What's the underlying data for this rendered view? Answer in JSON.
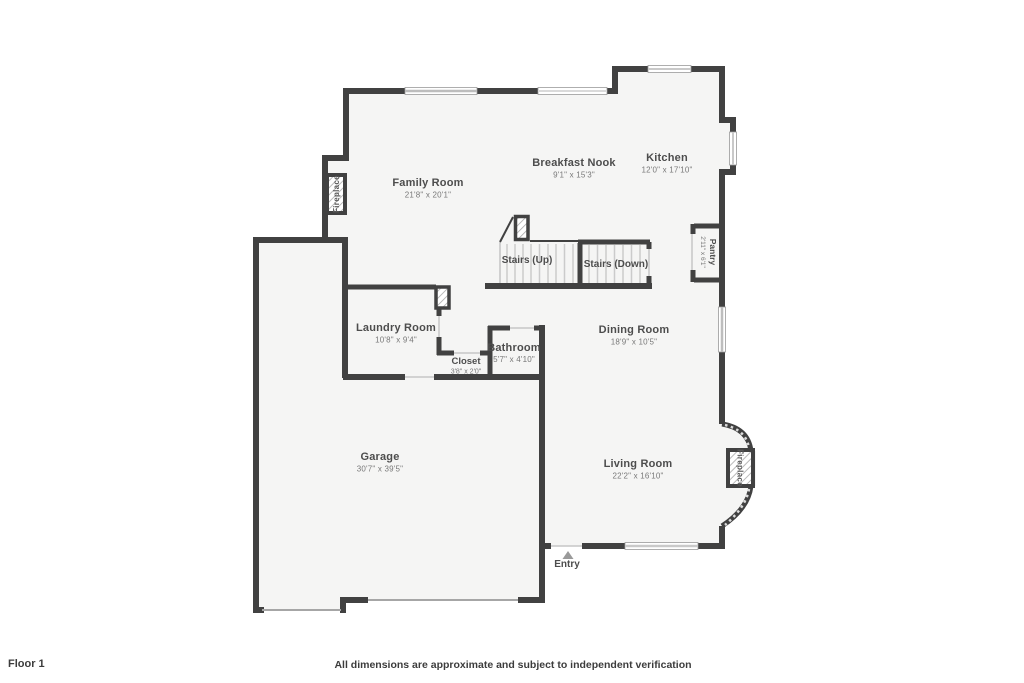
{
  "footer": {
    "floor_label": "Floor 1",
    "disclaimer": "All dimensions are approximate and subject to independent verification"
  },
  "rooms": {
    "family_room": {
      "name": "Family Room",
      "dims": "21'8\" x 20'1\""
    },
    "breakfast_nook": {
      "name": "Breakfast Nook",
      "dims": "9'1\" x 15'3\""
    },
    "kitchen": {
      "name": "Kitchen",
      "dims": "12'0\" x 17'10\""
    },
    "pantry": {
      "name": "Pantry",
      "dims": "2'11\" x 6'1\""
    },
    "laundry_room": {
      "name": "Laundry Room",
      "dims": "10'8\" x 9'4\""
    },
    "closet": {
      "name": "Closet",
      "dims": "3'8\" x 2'0\""
    },
    "bathroom": {
      "name": "Bathroom",
      "dims": "5'7\" x 4'10\""
    },
    "dining_room": {
      "name": "Dining Room",
      "dims": "18'9\" x 10'5\""
    },
    "living_room": {
      "name": "Living Room",
      "dims": "22'2\" x 16'10\""
    },
    "garage": {
      "name": "Garage",
      "dims": "30'7\" x 39'5\""
    }
  },
  "features": {
    "stairs_up": "Stairs (Up)",
    "stairs_down": "Stairs (Down)",
    "entry": "Entry",
    "fireplace_family": "Fireplace",
    "fireplace_living": "Fireplace"
  },
  "colors": {
    "wall": "#414141",
    "floor": "#f5f5f4",
    "window": "#c0c0c0",
    "room_name_text": "#4d4d4d",
    "room_dims_text": "#787878",
    "entry_arrow": "#9a9a9a",
    "background": "#ffffff"
  }
}
